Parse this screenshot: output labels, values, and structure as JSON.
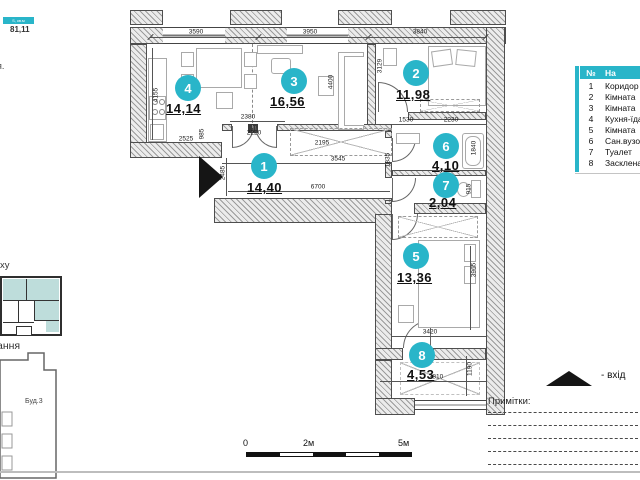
{
  "header": {
    "area_bar_label": "S, кв.м",
    "total_area": "81,11"
  },
  "left_column": {
    "fragment_1": "я.",
    "fragment_2": "ху",
    "fragment_3": "ання",
    "building_label": "Буд.3"
  },
  "table": {
    "col_num": "№",
    "col_name": "На",
    "rows": [
      {
        "n": "1",
        "name": "Коридор"
      },
      {
        "n": "2",
        "name": "Кімната"
      },
      {
        "n": "3",
        "name": "Кімната"
      },
      {
        "n": "4",
        "name": "Кухня-їдал"
      },
      {
        "n": "5",
        "name": "Кімната"
      },
      {
        "n": "6",
        "name": "Сан.вузол"
      },
      {
        "n": "7",
        "name": "Туалет"
      },
      {
        "n": "8",
        "name": "Засклена"
      }
    ]
  },
  "rooms": [
    {
      "n": "1",
      "area": "14,40"
    },
    {
      "n": "2",
      "area": "11,98"
    },
    {
      "n": "3",
      "area": "16,56"
    },
    {
      "n": "4",
      "area": "14,14"
    },
    {
      "n": "5",
      "area": "13,36"
    },
    {
      "n": "6",
      "area": "4,10"
    },
    {
      "n": "7",
      "area": "2,04"
    },
    {
      "n": "8",
      "area": "4,53"
    }
  ],
  "dims": {
    "d3590": "3590",
    "d3950": "3950",
    "d3840": "3840",
    "d4155": "4155",
    "d4400": "4400",
    "d3129": "3129",
    "d2525": "2525",
    "d985": "985",
    "d2380": "2380",
    "d2220": "2220",
    "d2195": "2195",
    "d3545": "3545",
    "d6700": "6700",
    "d2485": "2485",
    "d1530": "1530",
    "d2230": "2230",
    "d1835": "1835",
    "d1840": "1840",
    "d915": "915",
    "d3965": "3965",
    "d3420": "3420",
    "d3810": "3810",
    "d1190": "1190"
  },
  "legend": {
    "entrance": "- вхід",
    "notes": "Примітки:"
  },
  "scale": {
    "t0": "0",
    "t2": "2м",
    "t5": "5м"
  },
  "colors": {
    "accent": "#29b5c9",
    "key_plan_fill": "#bedddb"
  }
}
